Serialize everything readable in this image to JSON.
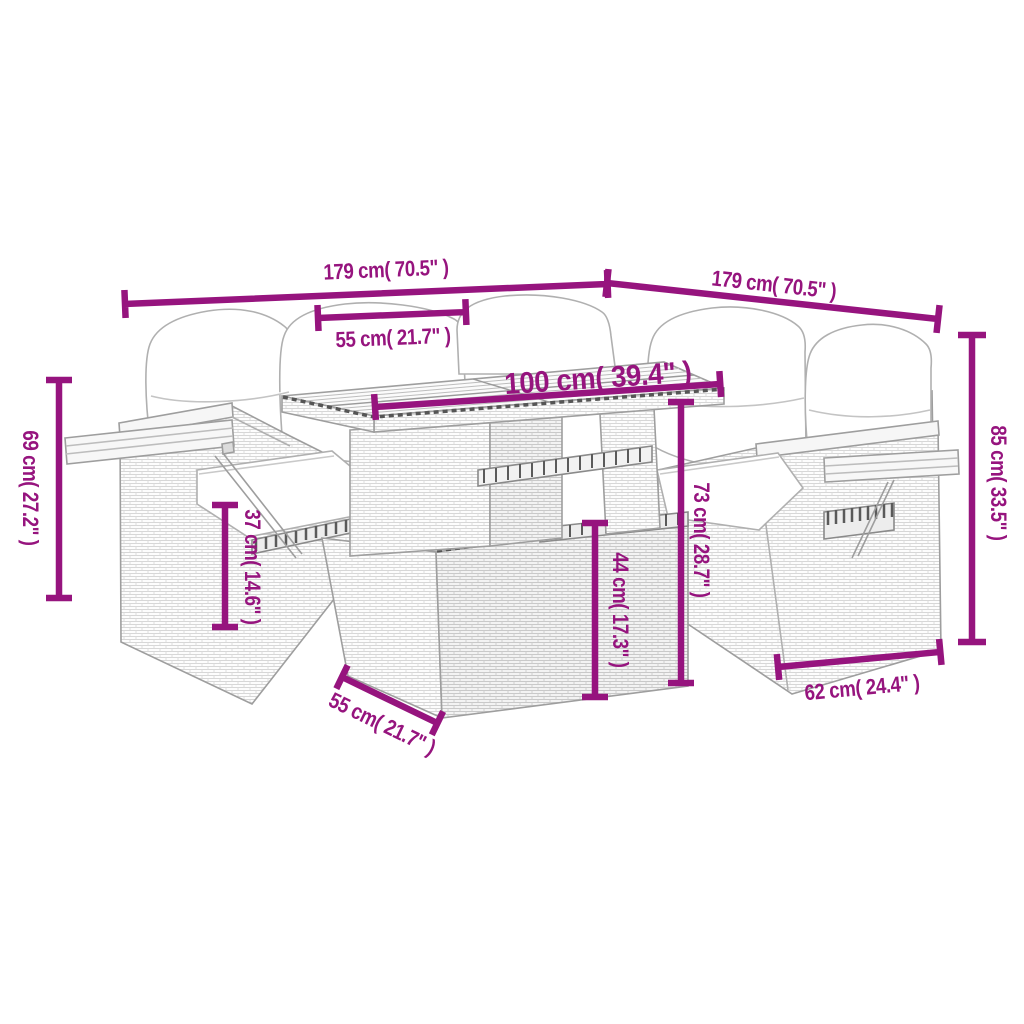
{
  "accent_color": "#96147E",
  "artwork": {
    "line_color": "#9E9E9E",
    "subject": "rattan-corner-sofa-set-with-adjustable-table-line-drawing"
  },
  "dimensions": {
    "width_left": "179 cm( 70.5\" )",
    "width_right": "179 cm( 70.5\" )",
    "seat_width": "55 cm( 21.7\" )",
    "table_length": "100 cm( 39.4\" )",
    "left_height": "69 cm( 27.2\" )",
    "seat_height": "37 cm( 14.6\" )",
    "table_lower_height": "44 cm( 17.3\" )",
    "table_height": "73 cm( 28.7\" )",
    "total_height": "85 cm( 33.5\" )",
    "seat_depth": "62 cm( 24.4\" )",
    "table_depth": "55 cm( 21.7\" )"
  }
}
